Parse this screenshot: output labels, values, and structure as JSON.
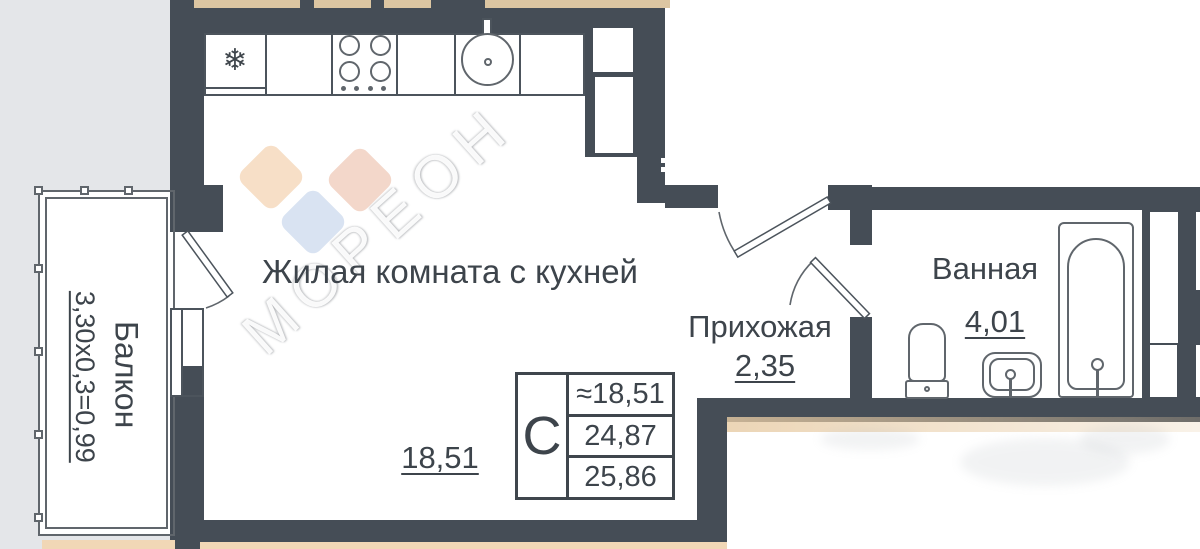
{
  "labels": {
    "living_room": "Жилая комната с кухней",
    "living_area": "18,51",
    "hallway": "Прихожая",
    "hallway_area": "2,35",
    "bathroom": "Ванная",
    "bathroom_area": "4,01",
    "balcony": "Балкон",
    "balcony_dimension": "3,30х0,3=0,99"
  },
  "stamp": {
    "letter": "С",
    "row1": "≈18,51",
    "row2": "24,87",
    "row3": "25,86"
  },
  "watermark": {
    "text": "МОРЕОН"
  },
  "icons": {
    "fridge_glyph": "❄",
    "fridge_icon": "snowflake-icon"
  },
  "colors": {
    "wall": "#454d56",
    "page_bg": "#e4e6e9",
    "paper": "#ffffff",
    "line": "#60666c",
    "text": "#3d444b",
    "tan_top": "#dcc6a2",
    "tan_bottom": "#f1d7b6",
    "diamond_peach": "#f7dfc7",
    "diamond_pink": "#f3d7ca",
    "diamond_blue": "#d9e3f2"
  }
}
